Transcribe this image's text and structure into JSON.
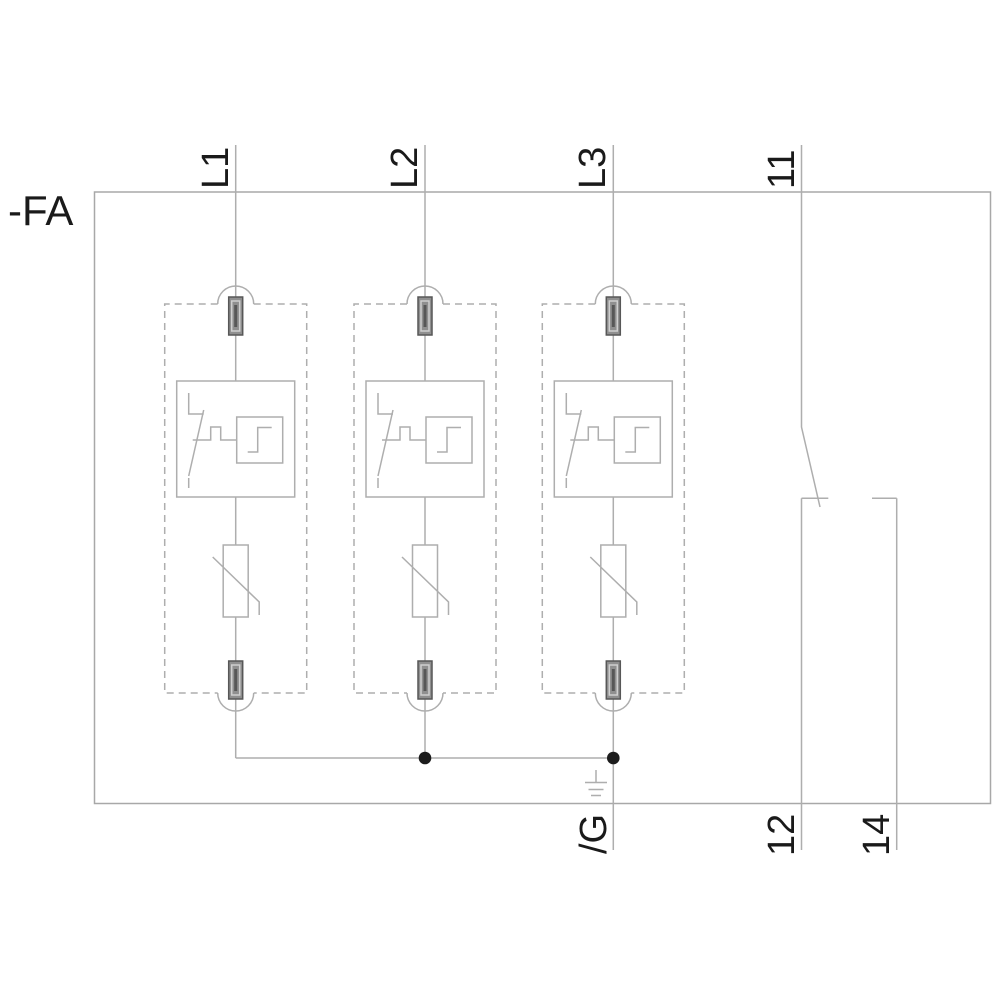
{
  "diagram": {
    "labels": {
      "device": "-FA",
      "phase1": "L1",
      "phase2": "L2",
      "phase3": "L3",
      "contact_common": "11",
      "contact_nc": "12",
      "contact_no": "14",
      "ground": "/G"
    },
    "colors": {
      "background": "#ffffff",
      "line": "#aeaeae",
      "label_text": "#1a1a1a",
      "terminal_fill": "#8f8f8f",
      "terminal_dark": "#575757",
      "terminal_light": "#cfcfcf",
      "junction_dot": "#1c1c1c"
    }
  }
}
